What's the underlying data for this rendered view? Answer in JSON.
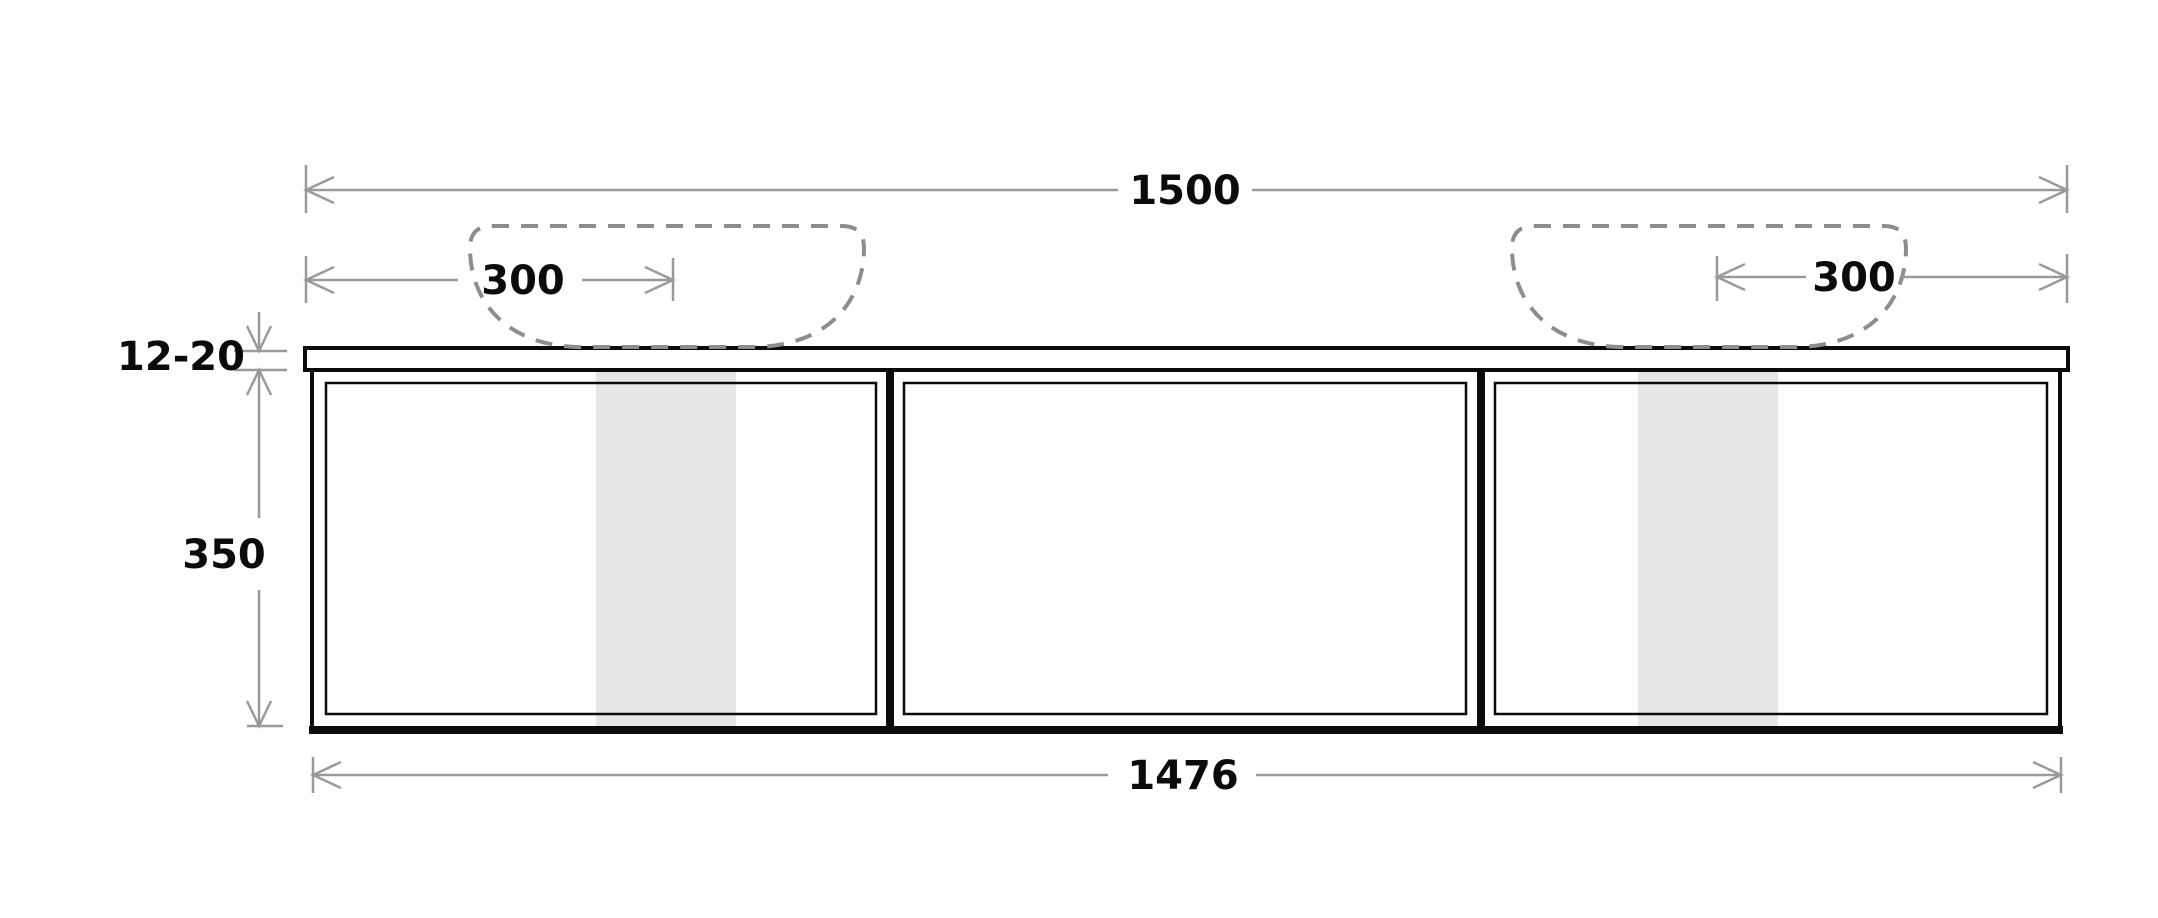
{
  "drawing": {
    "type": "technical-elevation",
    "subject": "wall-hung double basin vanity cabinet, front elevation with dimensions",
    "units": "mm",
    "labels": {
      "overall_width": "1500",
      "left_basin_offset": "300",
      "right_basin_offset": "300",
      "top_thickness": "12-20",
      "cabinet_height": "350",
      "cabinet_width": "1476"
    },
    "colors": {
      "line": "#0b0b0b",
      "dimension": "#9a9a9a",
      "hidden_outline": "#8d8d8d",
      "highlight_band": "#e6e6e6",
      "background": "#ffffff"
    }
  }
}
